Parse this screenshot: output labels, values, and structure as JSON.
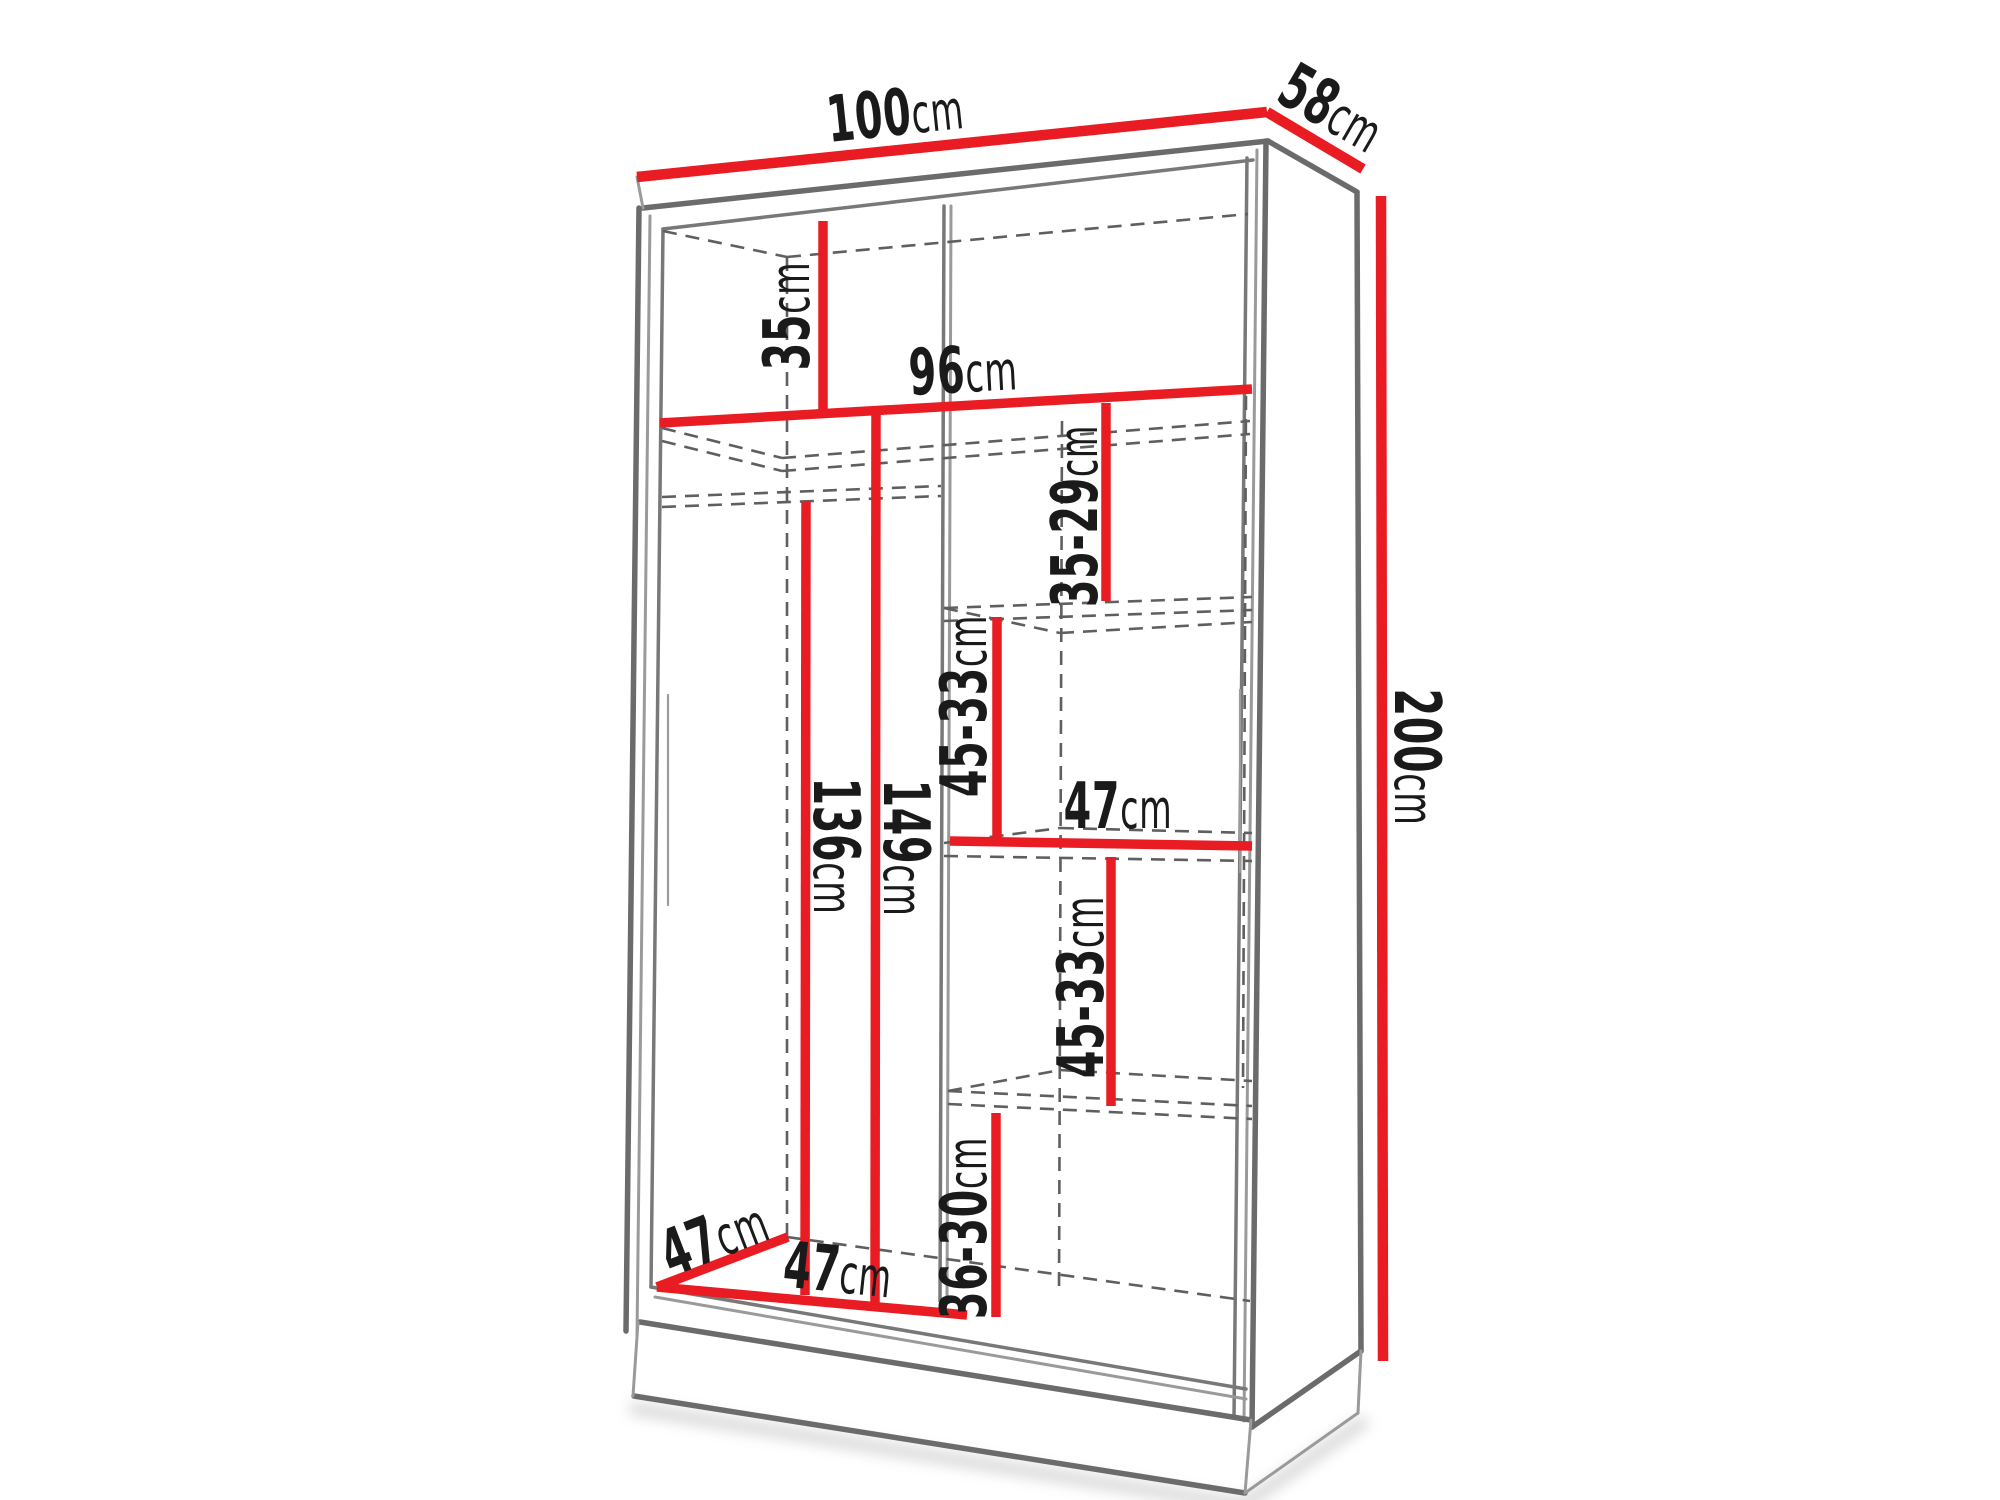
{
  "diagram": {
    "kind": "wardrobe-dimension-diagram",
    "unit": "cm",
    "colors": {
      "dimension-red": "#e81c22",
      "structure-gray": "#6b6b6b",
      "structure-gray-light": "#9a9a9a",
      "hidden-line-gray": "#5f5f5f",
      "label-black": "#1a1a1a",
      "background": "#ffffff"
    },
    "dimensions": {
      "width_top": {
        "value": "100",
        "unit": "cm"
      },
      "depth_top": {
        "value": "58",
        "unit": "cm"
      },
      "height_right": {
        "value": "200",
        "unit": "cm"
      },
      "top_shelf": {
        "value": "35",
        "unit": "cm"
      },
      "interior_width": {
        "value": "96",
        "unit": "cm"
      },
      "upper_gap": {
        "value": "35-29",
        "unit": "cm"
      },
      "middle_gap_upper": {
        "value": "45-33",
        "unit": "cm"
      },
      "middle_shelf_width": {
        "value": "47",
        "unit": "cm"
      },
      "middle_gap_lower": {
        "value": "45-33",
        "unit": "cm"
      },
      "bottom_gap": {
        "value": "36-30",
        "unit": "cm"
      },
      "hanging_height": {
        "value": "136",
        "unit": "cm"
      },
      "interior_height": {
        "value": "149",
        "unit": "cm"
      },
      "interior_depth": {
        "value": "47",
        "unit": "cm"
      },
      "bottom_width": {
        "value": "47",
        "unit": "cm"
      }
    }
  }
}
